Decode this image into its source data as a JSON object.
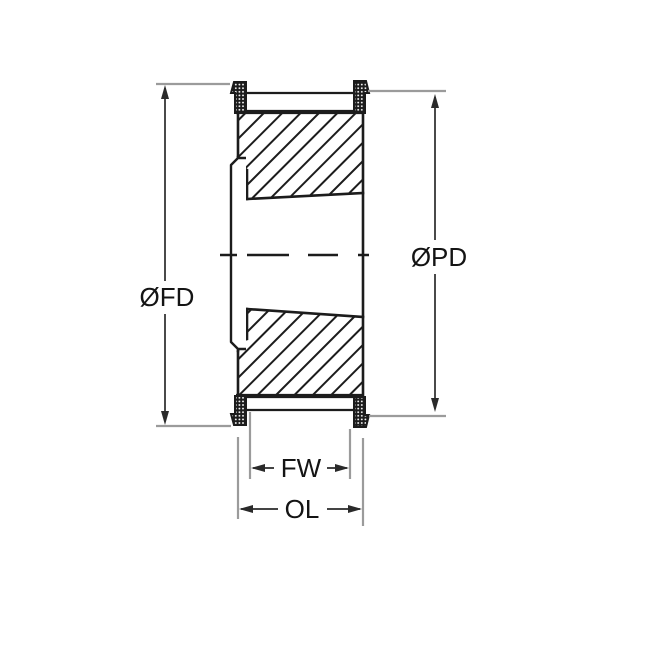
{
  "drawing": {
    "kind": "taper-bore timing pulley cross-section",
    "labels": {
      "flange_diameter": "ØFD",
      "pitch_diameter": "ØPD",
      "face_width": "FW",
      "overall_length": "OL"
    },
    "colors": {
      "line": "#1c1c1c",
      "dimension_line": "#2a2a2a",
      "extension_line": "#9b9b9b",
      "text": "#141414",
      "background": "#ffffff"
    }
  }
}
